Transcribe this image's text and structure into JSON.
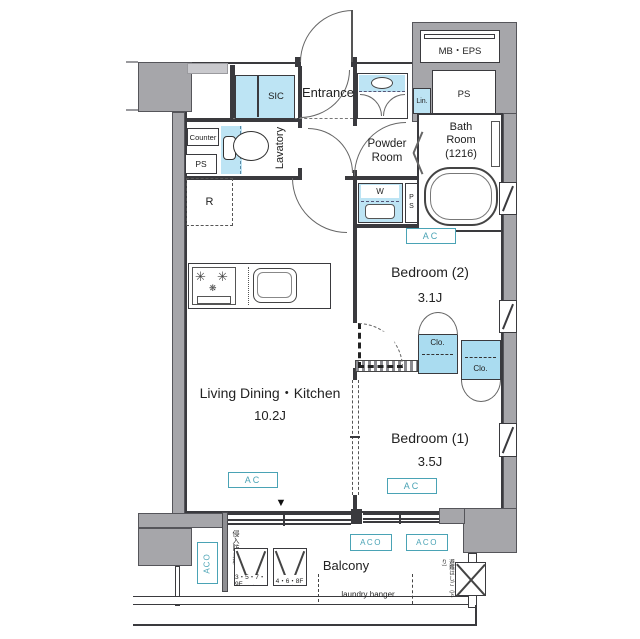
{
  "title": "Apartment floor plan",
  "labels": {
    "entrance": "Entrance",
    "sic": "SIC",
    "lavatory": "Lavatory",
    "counter": "Counter",
    "ps": "PS",
    "refrigerator": "R",
    "powder_room": "Powder\nRoom",
    "bath_room": "Bath\nRoom\n(1216)",
    "lin": "Lin.",
    "washer": "W",
    "ps_vertical": "P\nS",
    "mb_eps": "MB・EPS",
    "ac": "AC",
    "aco": "ACO",
    "clo": "Clo.",
    "bedroom2": "Bedroom (2)",
    "bedroom2_size": "3.1J",
    "bedroom1": "Bedroom (1)",
    "bedroom1_size": "3.5J",
    "ldk": "Living Dining・Kitchen",
    "ldk_size": "10.2J",
    "balcony": "Balcony",
    "laundry_hanger": "laundry hanger",
    "hatch_floors_a": "3・5・7・9F",
    "hatch_floors_b": "4・6・8F",
    "intrusion_fence": "侵入防止柵",
    "escape_ladder": "避難はしご（下り）",
    "direction_marker": "▼",
    "burner": "✳",
    "burner_small": "❋"
  },
  "colors": {
    "wall_gray": "#a6a6aa",
    "light_gray": "#c9c9cd",
    "fixture_blue": "#bde4f4",
    "closet_blue": "#aadcf0",
    "accent_teal": "#4aa3b5",
    "line": "#3a3a3e"
  }
}
